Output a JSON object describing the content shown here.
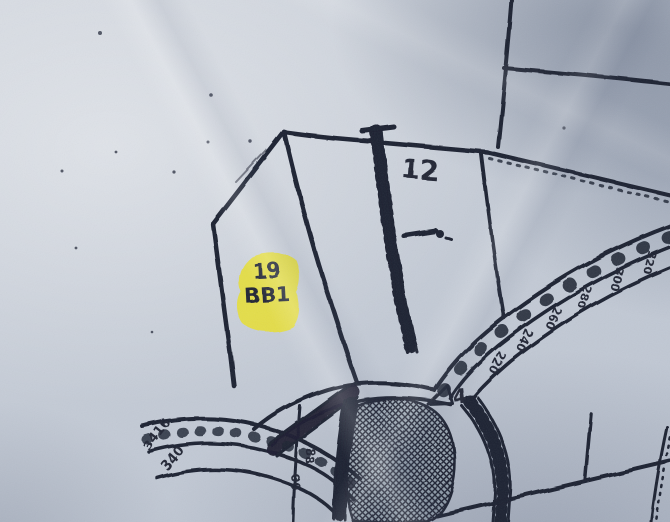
{
  "labels": {
    "lot_number": "19",
    "parcel_code": "BB1",
    "section_number": "12",
    "block_number": "4"
  },
  "road_markers": {
    "right_road": [
      "320",
      "300",
      "280",
      "260",
      "240",
      "220"
    ],
    "bottom_left_road": [
      "3416",
      "340"
    ],
    "center_bottom": [
      "88",
      "00"
    ]
  },
  "icons": {
    "railroad": "railroad-track-symbol",
    "survey_marker": "triangle-survey-marker",
    "crosshatch_area": "crosshatched-region"
  },
  "colors": {
    "paper": "#c7cdd7",
    "ink": "#1b2030",
    "highlight": "#e7e034",
    "shadow": "#8f9aae"
  }
}
